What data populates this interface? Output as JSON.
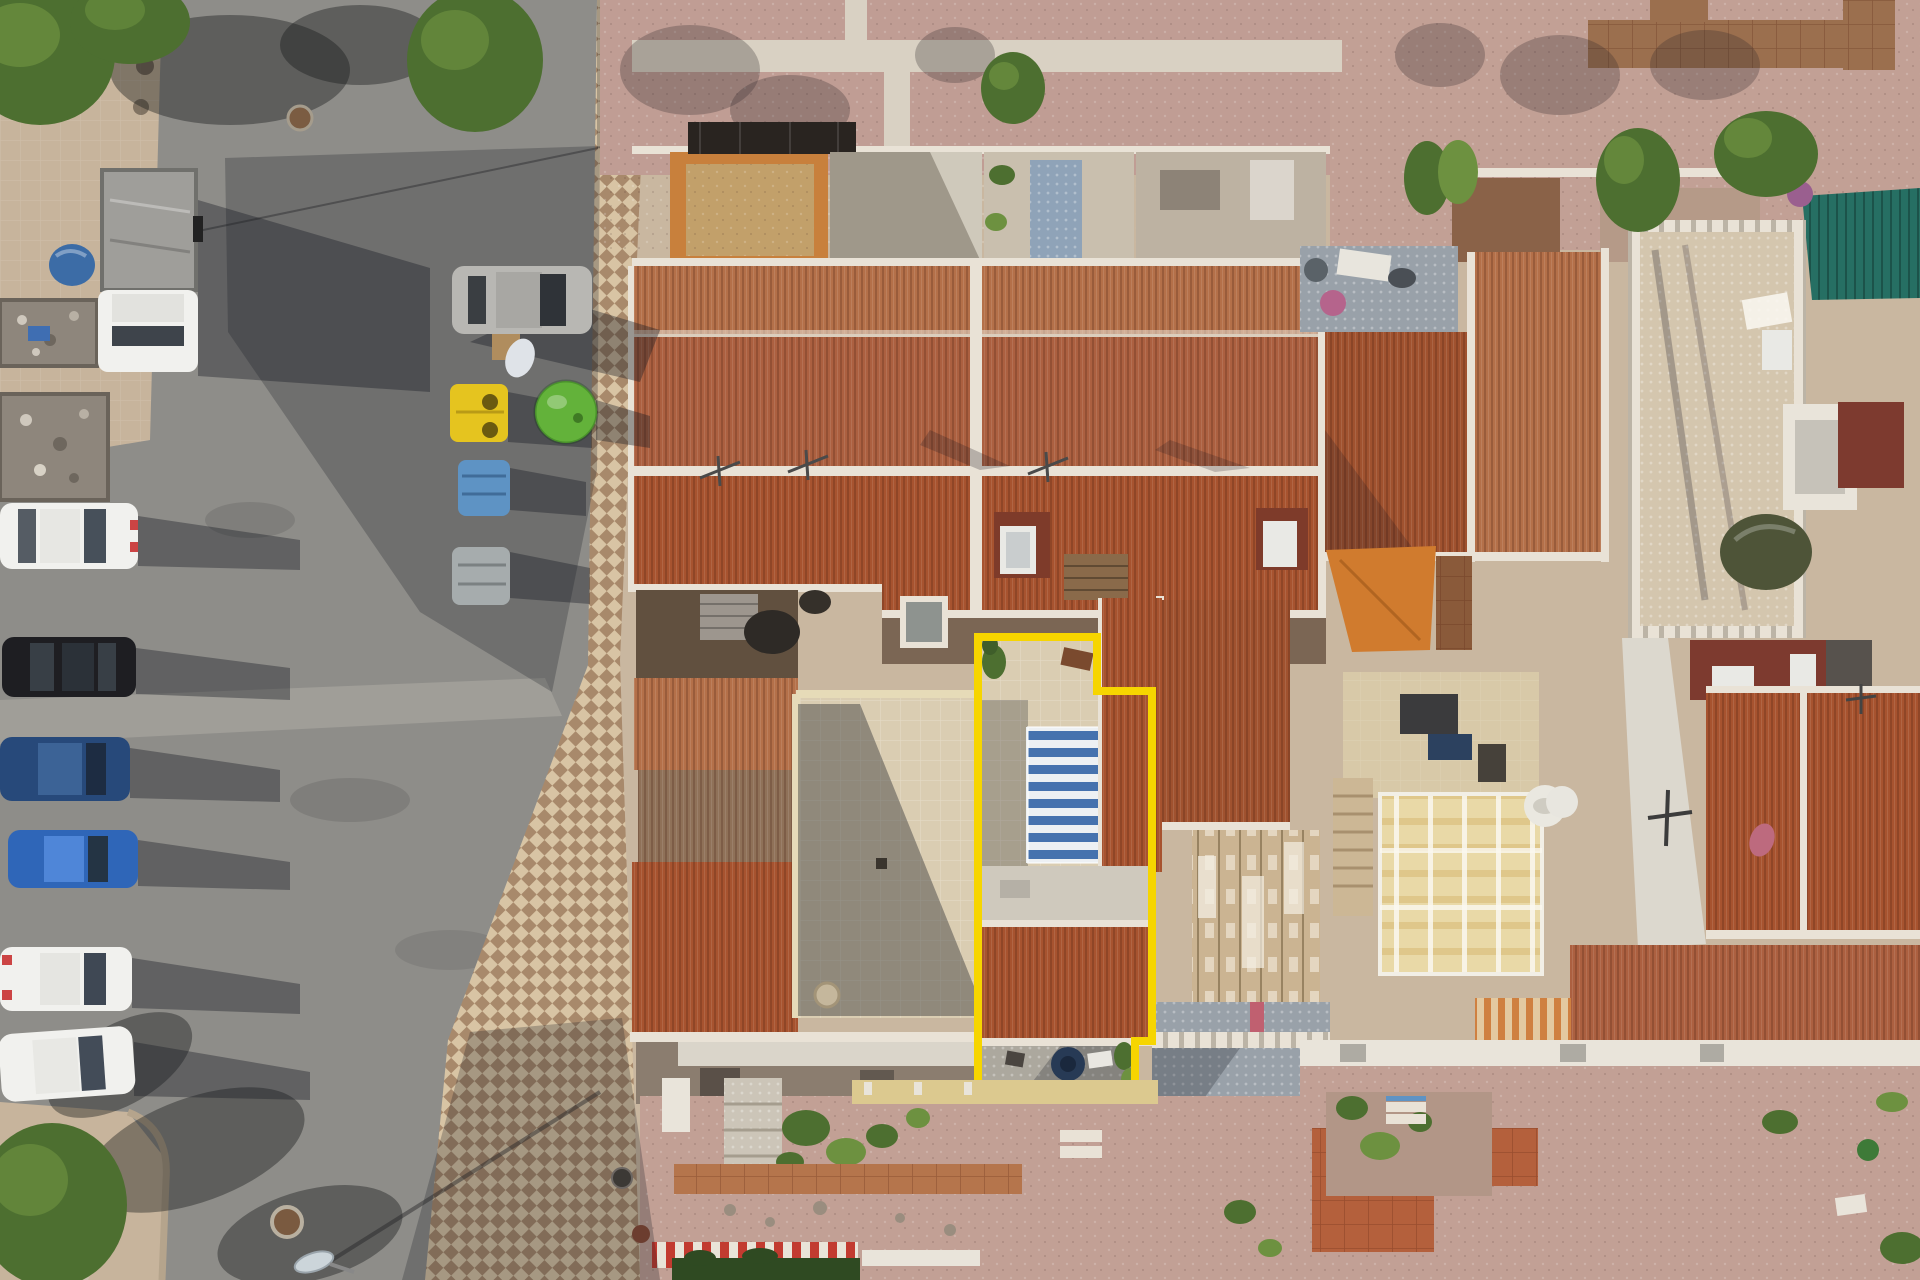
{
  "meta": {
    "image_type": "aerial-drone-photograph",
    "description": "Top-down drone view of a Mediterranean terraced-house block. One townhouse plot is traced with a bright yellow boundary line; it contains a tiled patio, a blue-and-white striped awning, a terracotta roof and a rear courtyard. A grey asphalt street with parked cars, a flatbed truck and recycling containers runs along the left; terracotta roofs, rooftop terraces, pergolas and back gardens fill the right.",
    "width_px": 1920,
    "height_px": 1280
  },
  "highlight": {
    "label": "property-boundary",
    "shape": "stepped-rectangle",
    "color": "#f6d500",
    "features": [
      "roof terrace patio",
      "blue-white striped awning",
      "terracotta roof",
      "lower patio with round table",
      "rear wall"
    ]
  },
  "street": {
    "surface": "asphalt",
    "parked_vehicles": [
      "white flatbed truck",
      "white hatchback",
      "black car",
      "dark-blue car",
      "blue car",
      "white car",
      "white estate car",
      "silver car"
    ],
    "recycling_bins": [
      "yellow clothing bank",
      "green glass igloo",
      "blue container",
      "grey container"
    ],
    "objects": [
      "rubble skips",
      "blue tarp bundle",
      "cardboard box",
      "plastic bag",
      "manhole covers",
      "street lamp",
      "checkerboard pavement",
      "street trees"
    ]
  },
  "neighborhood": {
    "roof_material": "terracotta tile",
    "features": [
      "front courtyards",
      "gravel plaza with concrete paths",
      "black pergola frame",
      "weathered wooden pergola",
      "cream folding canopy",
      "orange shade sail",
      "teal corrugated awning",
      "white crenellated roof terrace",
      "green tarp bundle",
      "back gardens with gravel and shrubs",
      "red-white striped barrier",
      "garden hedge"
    ]
  },
  "palette": {
    "asphalt": "#8e8d89",
    "asphalt_light": "#a3a19b",
    "sidewalk_beige": "#c7b49c",
    "check_light": "#d8c4a4",
    "check_dark": "#a8896b",
    "plaster": "#c9b7a0",
    "gravel_pink": "#c09d94",
    "gravel_pink2": "#c2a095",
    "path_concrete": "#d9d1c3",
    "tile_brown": "#9b6f4e",
    "roof_upper": "#b47049",
    "roof_mid": "#ac6040",
    "roof_lower": "#a7532f",
    "roof_red": "#a0522f",
    "roof_weathered": "#8f7158",
    "ridge_white": "#e9e2d6",
    "skylight_patch": "#7e3b2a",
    "skylight_white": "#e9e9e5",
    "patio_beige": "#dacdb2",
    "awning_blue": "#4672ae",
    "awning_white": "#edf0f3",
    "highlight_yellow": "#f6d500",
    "wall_yellow": "#dcc98f",
    "gray_patio": "#99a1a9",
    "pergola_plank": "#cbb492",
    "teal_roof": "#266f63",
    "orange_sail": "#d07b2e",
    "cream_canopy": "#e9d9a7",
    "cream_stripe": "#dfc78a",
    "flat_red": "#7d3a2f",
    "flat_gray": "#57524d",
    "terrace_mosaic": "#d4c6ae",
    "terrace_beige": "#d8c9a8",
    "stairs_beige": "#ccb795",
    "white_struct": "#e9e4da",
    "tarp_green": "#4e5438",
    "tree_green": "#4d6f30",
    "tree_light": "#6d9140",
    "car_white": "#f1f1ee",
    "car_black": "#1e1e22",
    "car_navy": "#27497a",
    "car_blue": "#2f66b8",
    "car_silver": "#b8b7b3",
    "bin_yellow": "#e5c41f",
    "bin_green": "#63b23a",
    "bin_blue": "#5e93c4",
    "bin_gray": "#a6acad",
    "truck_bed": "#9f9e9a",
    "box_brown": "#b08d5e",
    "terracotta_patio": "#b4603c",
    "orange_path": "#b5754c",
    "hedge_green": "#2f4a22",
    "fence_red": "#c23b30",
    "navy_table": "#273a55",
    "lamp_glow": "#ccd5da",
    "orange_court": "#c8803c",
    "courtyard_dark": "#61503f"
  }
}
